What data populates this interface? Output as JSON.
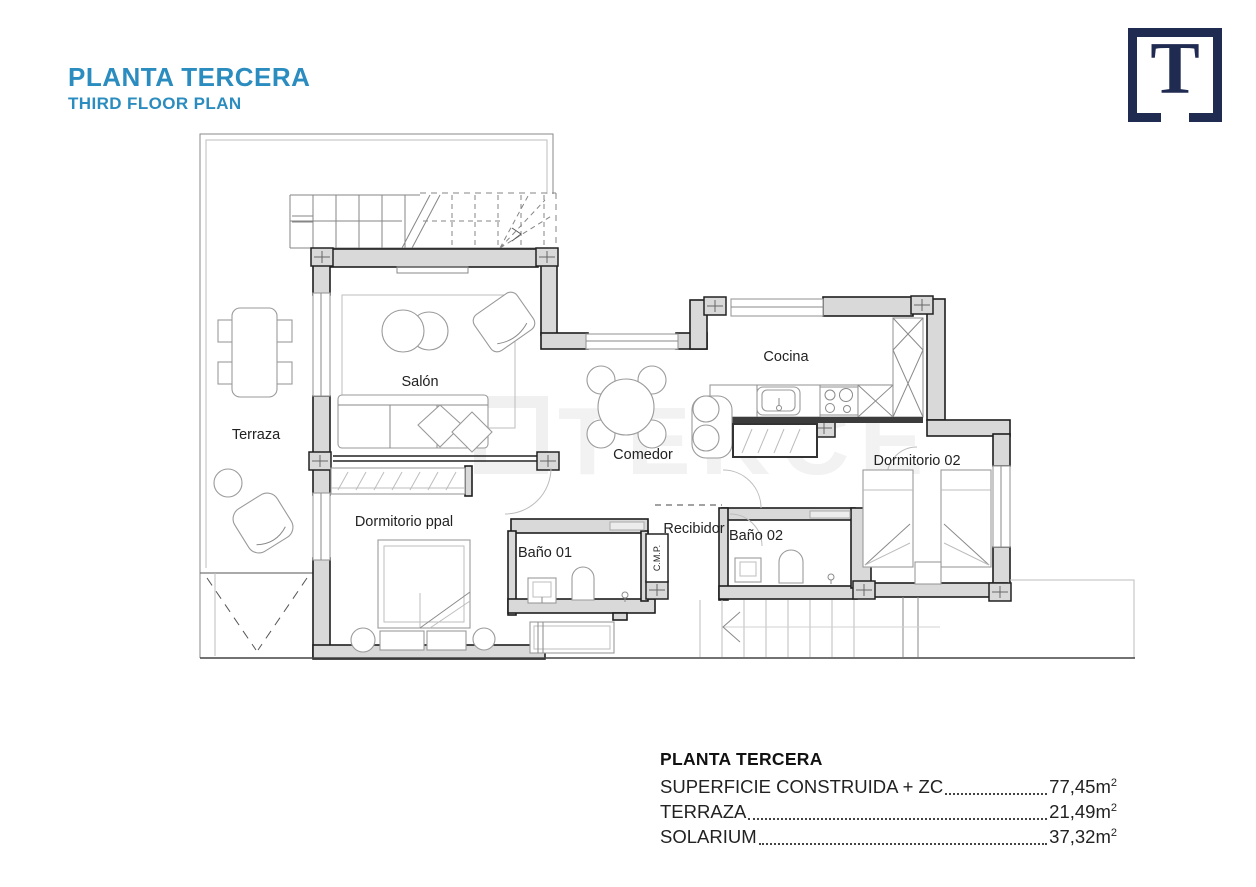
{
  "header": {
    "title": "PLANTA TERCERA",
    "subtitle": "THIRD FLOOR PLAN",
    "title_color": "#2b8cbf"
  },
  "logo": {
    "letter": "T",
    "color": "#202b52"
  },
  "watermark": {
    "text": "TEKCE"
  },
  "plan": {
    "labels": {
      "terraza": "Terraza",
      "salon": "Salón",
      "cocina": "Cocina",
      "comedor": "Comedor",
      "dormitorio02": "Dormitorio 02",
      "dormitorioPpal": "Dormitorio ppal",
      "bano01": "Baño 01",
      "bano02": "Baño 02",
      "recibidor": "Recibidor",
      "cmp": "C.M.P."
    },
    "wall_color": "#d9d9d9"
  },
  "legend": {
    "title": "PLANTA TERCERA",
    "rows": [
      {
        "label": "SUPERFICIE CONSTRUIDA + ZC",
        "value": "77,45m",
        "sup": "2"
      },
      {
        "label": "TERRAZA",
        "value": "21,49m",
        "sup": "2"
      },
      {
        "label": "SOLARIUM",
        "value": "37,32m",
        "sup": "2"
      }
    ]
  }
}
